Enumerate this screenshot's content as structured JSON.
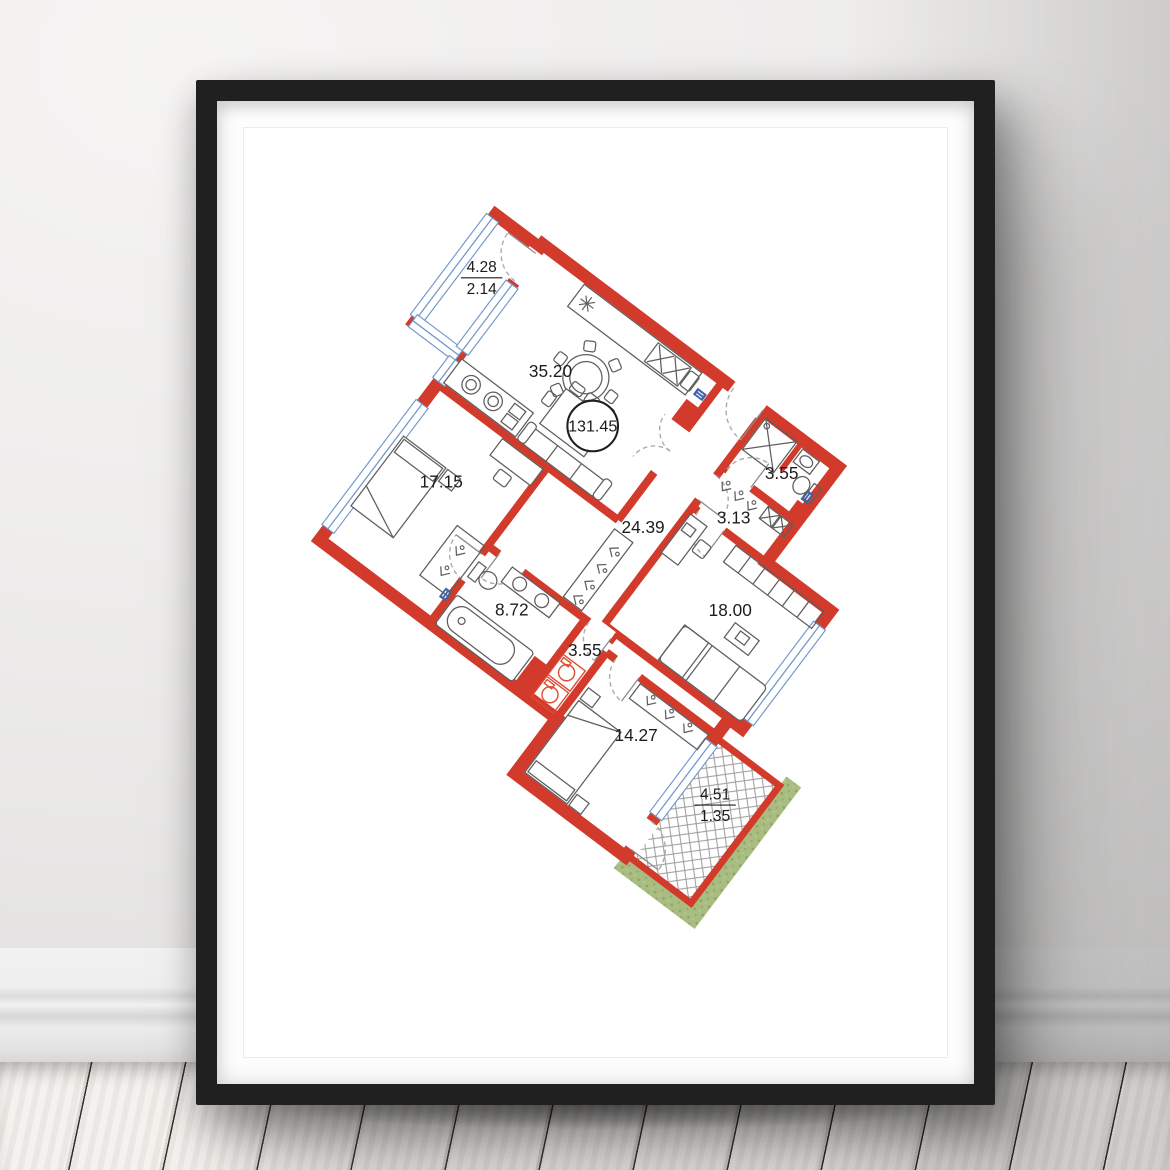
{
  "artwork": {
    "type": "floor-plan-poster",
    "total_area": "131.45",
    "rooms": [
      {
        "name": "living-kitchen",
        "area": "35.20"
      },
      {
        "name": "balcony-top",
        "area_full": "4.28",
        "area_reduced": "2.14"
      },
      {
        "name": "bathroom-entrance",
        "area": "3.55"
      },
      {
        "name": "hallway-closet",
        "area": "3.13"
      },
      {
        "name": "corridor",
        "area": "24.39"
      },
      {
        "name": "bedroom-left",
        "area": "17.15"
      },
      {
        "name": "bedroom-right",
        "area": "18.00"
      },
      {
        "name": "bathroom-main",
        "area": "8.72"
      },
      {
        "name": "laundry",
        "area": "3.55"
      },
      {
        "name": "bedroom-bottom",
        "area": "14.27"
      },
      {
        "name": "balcony-bottom",
        "area_full": "4.51",
        "area_reduced": "1.35"
      }
    ],
    "colors": {
      "wall": "#d23b2b",
      "window": "#6f97cc",
      "greenery": "#a9bd82",
      "frame": "#202020",
      "mat": "#ffffff"
    }
  }
}
